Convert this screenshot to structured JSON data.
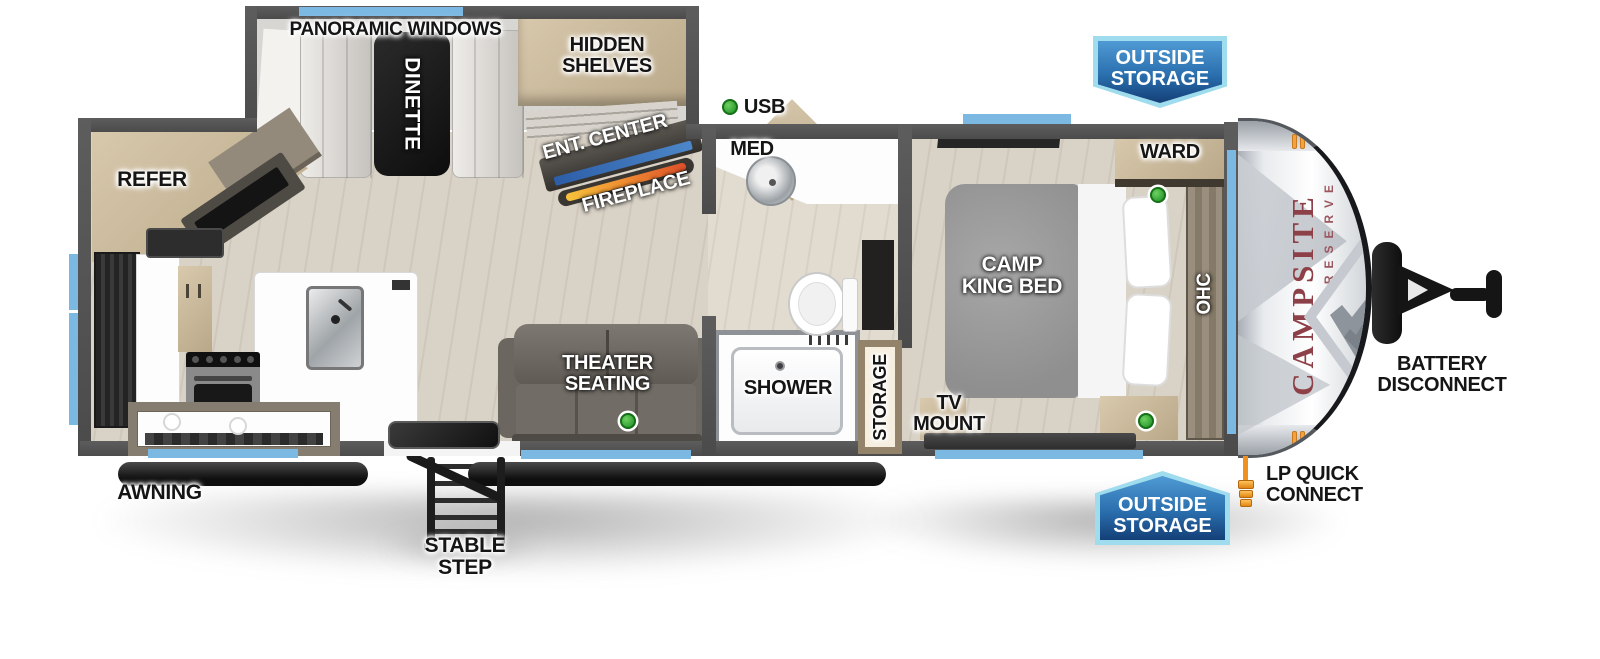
{
  "floorplan": {
    "brand": {
      "name": "CAMPSITE",
      "series": "RESERVE"
    },
    "legend": {
      "usb": "USB"
    },
    "living": {
      "panoramic_windows": "PANORAMIC WINDOWS",
      "dinette": "DINETTE",
      "hidden_shelves_1": "HIDDEN",
      "hidden_shelves_2": "SHELVES",
      "ent_center": "ENT. CENTER",
      "fireplace": "FIREPLACE",
      "refer": "REFER",
      "theater_1": "THEATER",
      "theater_2": "SEATING"
    },
    "bathroom": {
      "med": "MED",
      "shower": "SHOWER",
      "storage": "STORAGE"
    },
    "bedroom": {
      "bed_1": "CAMP",
      "bed_2": "KING BED",
      "ward": "WARD",
      "ohc": "OHC",
      "tv_1": "TV",
      "tv_2": "MOUNT"
    },
    "exterior": {
      "awning": "AWNING",
      "stable_step": "STABLE STEP",
      "outside_storage_1": "OUTSIDE",
      "outside_storage_2": "STORAGE",
      "battery_1": "BATTERY",
      "battery_2": "DISCONNECT",
      "lp_1": "LP QUICK",
      "lp_2": "CONNECT"
    },
    "colors": {
      "window_blue": "#7cb9e2",
      "badge_blue": "#2a6fae",
      "badge_border": "#9fdcee",
      "usb_green": "#3cb43c",
      "brand_red": "#8e4048",
      "accent_orange": "#f6a23c",
      "fireplace_flame": "#ef8b31",
      "wall_gray": "#545454"
    }
  }
}
